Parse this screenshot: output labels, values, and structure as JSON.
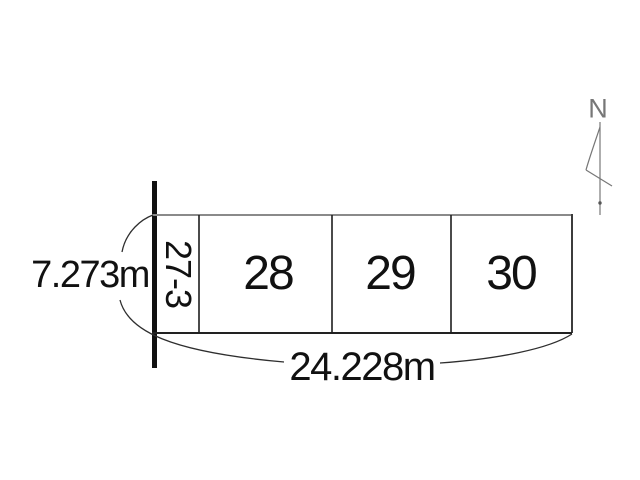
{
  "diagram": {
    "north_label": "N",
    "parcels": [
      {
        "label": "27-3",
        "orientation": "vertical"
      },
      {
        "label": "28",
        "orientation": "horizontal"
      },
      {
        "label": "29",
        "orientation": "horizontal"
      },
      {
        "label": "30",
        "orientation": "horizontal"
      }
    ],
    "dimensions": {
      "left": "7.273m",
      "bottom": "24.228m"
    }
  },
  "colors": {
    "ink": "#111111",
    "line": "#2e2e2e",
    "edge-gray": "#8a8a8a",
    "north": "#777777",
    "bg": "#ffffff"
  }
}
